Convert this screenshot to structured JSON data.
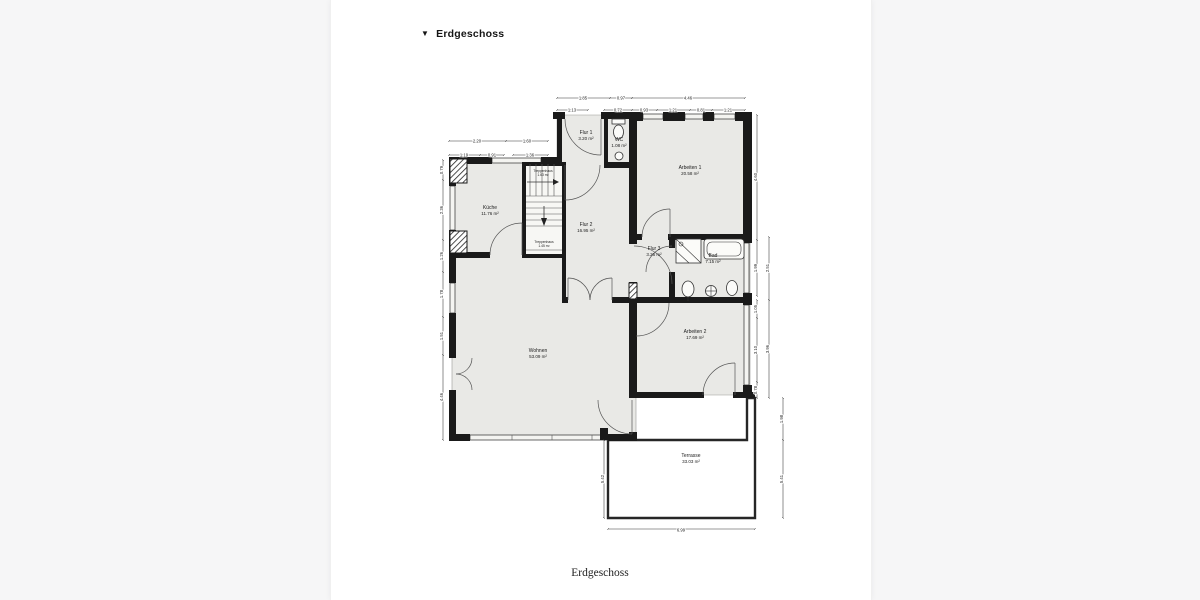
{
  "header": {
    "collapse_icon": "▼",
    "title": "Erdgeschoss"
  },
  "caption": "Erdgeschoss",
  "colors": {
    "wall": "#1a1a1a",
    "room_fill": "#e9e9e6",
    "paper": "#ffffff",
    "canvas": "#f6f6f7",
    "dim_text": "#1c1c1c"
  },
  "plan": {
    "rooms": [
      {
        "name": "Küche",
        "area": "11.76 m²",
        "x": 490,
        "y": 209
      },
      {
        "name": "Flur 1",
        "area": "3.20 m²",
        "x": 586,
        "y": 134
      },
      {
        "name": "WC",
        "area": "1.08 m²",
        "x": 619,
        "y": 141
      },
      {
        "name": "Arbeiten 1",
        "area": "20.58 m²",
        "x": 690,
        "y": 169
      },
      {
        "name": "Flur 2",
        "area": "16.95 m²",
        "x": 586,
        "y": 226
      },
      {
        "name": "Flur 3",
        "area": "3.26 m²",
        "x": 654,
        "y": 250
      },
      {
        "name": "Bad",
        "area": "7.15 m²",
        "x": 713,
        "y": 257
      },
      {
        "name": "Arbeiten 2",
        "area": "17.69 m²",
        "x": 695,
        "y": 333
      },
      {
        "name": "Wohnen",
        "area": "53.09 m²",
        "x": 538,
        "y": 352
      },
      {
        "name": "Terrasse",
        "area": "33.03 m²",
        "x": 691,
        "y": 457
      },
      {
        "name": "Treppenhaus",
        "area": "1.63 m²",
        "x": 543,
        "y": 172,
        "small": true
      },
      {
        "name": "Treppenhaus",
        "area": "1.45 m²",
        "x": 544,
        "y": 243,
        "small": true
      }
    ],
    "dims": [
      {
        "v": "1.85",
        "x": 583,
        "y": 99.5,
        "rot": 0
      },
      {
        "v": "0.97",
        "x": 621,
        "y": 99.5,
        "rot": 0
      },
      {
        "v": "4.46",
        "x": 688,
        "y": 99.5,
        "rot": 0
      },
      {
        "v": "1.13",
        "x": 572,
        "y": 111.5,
        "rot": 0
      },
      {
        "v": "0.72",
        "x": 618,
        "y": 111.5,
        "rot": 0
      },
      {
        "v": "0.93",
        "x": 644,
        "y": 111.5,
        "rot": 0
      },
      {
        "v": "1.21",
        "x": 673,
        "y": 111.5,
        "rot": 0
      },
      {
        "v": "0.81",
        "x": 701,
        "y": 111.5,
        "rot": 0
      },
      {
        "v": "1.21",
        "x": 728,
        "y": 111.5,
        "rot": 0
      },
      {
        "v": "2.20",
        "x": 477,
        "y": 142.5,
        "rot": 0
      },
      {
        "v": "1.60",
        "x": 527,
        "y": 142.5,
        "rot": 0
      },
      {
        "v": "1.19",
        "x": 464,
        "y": 156.5,
        "rot": 0
      },
      {
        "v": "0.91",
        "x": 492,
        "y": 156.5,
        "rot": 0
      },
      {
        "v": "1.36",
        "x": 530,
        "y": 156.5,
        "rot": 0
      },
      {
        "v": "0.79",
        "x": 443,
        "y": 170,
        "rot": -90
      },
      {
        "v": "2.36",
        "x": 443,
        "y": 210,
        "rot": -90
      },
      {
        "v": "1.26",
        "x": 443,
        "y": 256,
        "rot": -90
      },
      {
        "v": "1.78",
        "x": 443,
        "y": 294,
        "rot": -90
      },
      {
        "v": "1.51",
        "x": 443,
        "y": 336,
        "rot": -90
      },
      {
        "v": "4.46",
        "x": 443,
        "y": 397,
        "rot": -90
      },
      {
        "v": "4.60",
        "x": 757,
        "y": 177,
        "rot": -90
      },
      {
        "v": "1.99",
        "x": 757,
        "y": 268,
        "rot": -90
      },
      {
        "v": "1.05",
        "x": 757,
        "y": 309,
        "rot": -90
      },
      {
        "v": "3.10",
        "x": 757,
        "y": 350,
        "rot": -90
      },
      {
        "v": "0.78",
        "x": 757,
        "y": 390,
        "rot": -90
      },
      {
        "v": "2.51",
        "x": 769,
        "y": 268,
        "rot": -90
      },
      {
        "v": "3.96",
        "x": 769,
        "y": 349,
        "rot": -90
      },
      {
        "v": "1.98",
        "x": 783,
        "y": 419,
        "rot": -90
      },
      {
        "v": "5.41",
        "x": 783,
        "y": 479,
        "rot": -90
      },
      {
        "v": "5.42",
        "x": 604,
        "y": 479,
        "rot": -90
      },
      {
        "v": "6.99",
        "x": 681,
        "y": 531.5,
        "rot": 0
      }
    ]
  }
}
